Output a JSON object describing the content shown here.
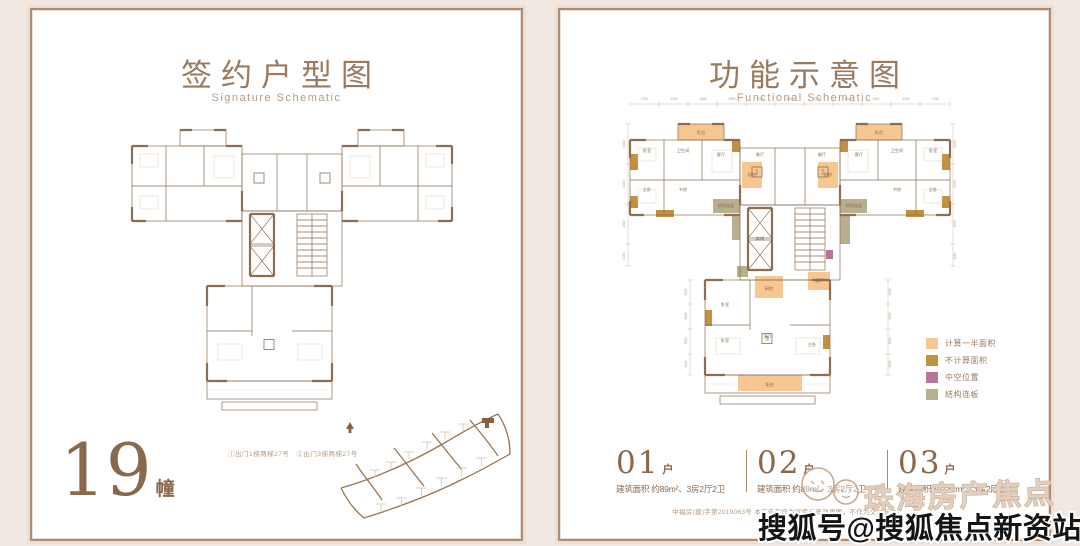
{
  "colors": {
    "accent": "#9a7a5e",
    "wall": "#8d6e52",
    "half_area": "#f6c791",
    "uncounted_area": "#c2913f",
    "void_area": "#b4779b",
    "slab_area": "#b6b08e"
  },
  "left_panel": {
    "title": "签约户型图",
    "subtitle": "Signature Schematic",
    "building_no": "19",
    "building_suffix": "幢",
    "note": "①出门1梯两梯27号　②出门3梯两梯27号",
    "plan_labels": [
      {
        "x": 81,
        "y": 24,
        "t": "阳台"
      },
      {
        "x": 259,
        "y": 24,
        "t": "阳台"
      },
      {
        "x": 140,
        "y": 62,
        "t": "入户花园",
        "s": 3.8
      },
      {
        "x": 202,
        "y": 62,
        "t": "入户花园",
        "s": 3.8
      },
      {
        "x": 100,
        "y": 91,
        "t": "结构连板",
        "s": 3.4
      },
      {
        "x": 240,
        "y": 91,
        "t": "结构连板",
        "s": 3.4
      },
      {
        "x": 134,
        "y": 190,
        "t": "入户花园",
        "s": 3.8
      },
      {
        "x": 192,
        "y": 190,
        "t": "绿化平台",
        "s": 3.8
      },
      {
        "x": 147,
        "y": 276,
        "t": "阳台"
      }
    ],
    "badge_nums": [
      {
        "x": 137,
        "y": 64.5,
        "t": "1"
      },
      {
        "x": 203,
        "y": 64.5,
        "t": "2"
      },
      {
        "x": 147,
        "y": 231,
        "t": "3"
      }
    ]
  },
  "right_panel": {
    "title": "功能示意图",
    "subtitle": "Functional Schematic",
    "legend": [
      {
        "label": "计算一半面积",
        "color": "#f6c791"
      },
      {
        "label": "不计算面积",
        "color": "#c2913f"
      },
      {
        "label": "中空位置",
        "color": "#b4779b"
      },
      {
        "label": "结构连板",
        "color": "#b6b08e"
      }
    ],
    "units": [
      {
        "no": "01",
        "suffix": "户",
        "area": "建筑面积 约89m²、3房2厅2卫"
      },
      {
        "no": "02",
        "suffix": "户",
        "area": "建筑面积 约89m²、3房2厅2卫"
      },
      {
        "no": "03",
        "suffix": "户",
        "area": "建筑面积 约132m²、3房2厅2卫"
      }
    ],
    "disclaimer": "中福房(建)字第2019063号 本广告仅作为宣传示意效果图，不作为交付标准。",
    "plan_labels": [
      {
        "x": 81,
        "y": 40,
        "t": "阳台"
      },
      {
        "x": 259,
        "y": 40,
        "t": "阳台"
      },
      {
        "x": 27,
        "y": 58,
        "t": "卧室"
      },
      {
        "x": 313,
        "y": 58,
        "t": "卧室"
      },
      {
        "x": 63,
        "y": 58,
        "t": "卫生间",
        "s": 3.4
      },
      {
        "x": 277,
        "y": 58,
        "t": "卫生间",
        "s": 3.4
      },
      {
        "x": 27,
        "y": 97,
        "t": "主卧"
      },
      {
        "x": 313,
        "y": 97,
        "t": "主卧"
      },
      {
        "x": 63,
        "y": 97,
        "t": "书房"
      },
      {
        "x": 277,
        "y": 97,
        "t": "书房"
      },
      {
        "x": 101,
        "y": 62,
        "t": "客厅"
      },
      {
        "x": 239,
        "y": 62,
        "t": "客厅"
      },
      {
        "x": 140,
        "y": 62,
        "t": "餐厅",
        "s": 3.8
      },
      {
        "x": 202,
        "y": 62,
        "t": "餐厅",
        "s": 3.8
      },
      {
        "x": 132,
        "y": 82,
        "t": "厨房",
        "s": 3.8
      },
      {
        "x": 208,
        "y": 82,
        "t": "厨房",
        "s": 3.8
      },
      {
        "x": 106,
        "y": 113,
        "t": "结构连板",
        "s": 3.2
      },
      {
        "x": 234,
        "y": 113,
        "t": "结构连板",
        "s": 3.2
      },
      {
        "x": 140,
        "y": 146,
        "t": "电梯",
        "s": 3.4
      },
      {
        "x": 149,
        "y": 196,
        "t": "厨房",
        "s": 3.8
      },
      {
        "x": 199,
        "y": 188,
        "t": "餐厅",
        "s": 3.8
      },
      {
        "x": 105,
        "y": 212,
        "t": "卧室"
      },
      {
        "x": 105,
        "y": 248,
        "t": "卧室"
      },
      {
        "x": 148,
        "y": 244,
        "t": "客厅"
      },
      {
        "x": 192,
        "y": 252,
        "t": "主卧"
      },
      {
        "x": 150,
        "y": 292,
        "t": "阳台"
      }
    ],
    "badge_nums": [
      {
        "x": 137,
        "y": 80.5,
        "t": "1"
      },
      {
        "x": 203,
        "y": 80.5,
        "t": "2"
      },
      {
        "x": 147,
        "y": 247,
        "t": "3"
      }
    ],
    "dims": [
      {
        "x": 24,
        "y": 6,
        "t": "1750"
      },
      {
        "x": 54,
        "y": 6,
        "t": "2900"
      },
      {
        "x": 83,
        "y": 6,
        "t": "1600"
      },
      {
        "x": 112,
        "y": 6,
        "t": "3900"
      },
      {
        "x": 140,
        "y": 6,
        "t": "2750"
      },
      {
        "x": 170,
        "y": 6,
        "t": "2150"
      },
      {
        "x": 198,
        "y": 6,
        "t": "2750"
      },
      {
        "x": 228,
        "y": 6,
        "t": "3900"
      },
      {
        "x": 256,
        "y": 6,
        "t": "1600"
      },
      {
        "x": 286,
        "y": 6,
        "t": "2900"
      },
      {
        "x": 315,
        "y": 6,
        "t": "1750"
      },
      {
        "x": 5,
        "y": 50,
        "t": "1400",
        "r": -90
      },
      {
        "x": 5,
        "y": 90,
        "t": "5400",
        "r": -90
      },
      {
        "x": 5,
        "y": 130,
        "t": "1500",
        "r": -90
      },
      {
        "x": 5,
        "y": 162,
        "t": "1100",
        "r": -90
      },
      {
        "x": 336,
        "y": 50,
        "t": "1400",
        "r": -90
      },
      {
        "x": 336,
        "y": 90,
        "t": "5400",
        "r": -90
      },
      {
        "x": 336,
        "y": 130,
        "t": "1500",
        "r": -90
      },
      {
        "x": 336,
        "y": 162,
        "t": "1100",
        "r": -90
      },
      {
        "x": 67,
        "y": 198,
        "t": "1500",
        "r": -90
      },
      {
        "x": 67,
        "y": 222,
        "t": "2600",
        "r": -90
      },
      {
        "x": 67,
        "y": 247,
        "t": "2850",
        "r": -90
      },
      {
        "x": 67,
        "y": 270,
        "t": "1400",
        "r": -90
      },
      {
        "x": 271,
        "y": 198,
        "t": "1400",
        "r": -90
      },
      {
        "x": 271,
        "y": 222,
        "t": "2900",
        "r": -90
      },
      {
        "x": 271,
        "y": 247,
        "t": "2600",
        "r": -90
      },
      {
        "x": 271,
        "y": 270,
        "t": "1500",
        "r": -90
      }
    ]
  },
  "watermark": {
    "line1": "珠海房产焦点",
    "line2": "搜狐号@搜狐焦点新资站"
  }
}
